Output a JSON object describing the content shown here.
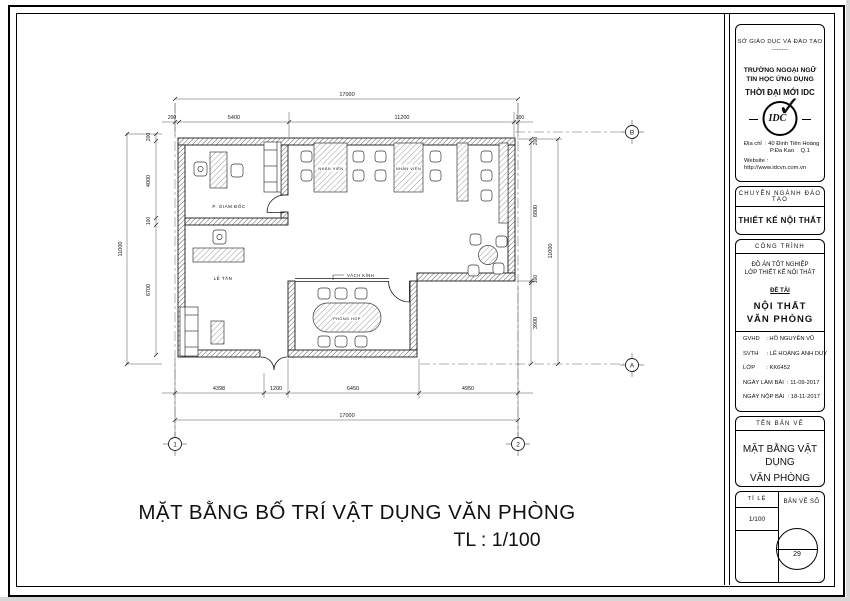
{
  "plan": {
    "labels": {
      "director": "P. GIÁM ĐỐC",
      "reception": "LỄ TÂN",
      "staff": "NHÂN VIÊN",
      "meeting": "PHÒNG HỌP",
      "glass": "VÁCH KÍNH"
    },
    "dims": {
      "top_total": "17000",
      "top": [
        "200",
        "5400",
        "11200",
        "200"
      ],
      "left_total": "11000",
      "left": [
        "200",
        "4000",
        "100",
        "6700"
      ],
      "right": [
        "200",
        "6800",
        "100",
        "3900"
      ],
      "right_total": "11000",
      "bottom": [
        "4398",
        "1200",
        "6450",
        "4950"
      ],
      "bottom_total": "17000"
    },
    "grid": {
      "c1": "1",
      "c2": "2",
      "rA": "A",
      "rB": "B"
    },
    "caption": "MẶT BẰNG BỐ TRÍ VẬT DỤNG VĂN PHÒNG",
    "caption_scale": "TL : 1/100"
  },
  "title_block": {
    "department": "SỞ GIÁO DỤC VÀ ĐÀO TẠO",
    "dots": "----------",
    "school_line1": "TRƯỜNG NGOẠI NGỮ",
    "school_line2": "TIN HỌC ỨNG DỤNG",
    "school_brand": "THỜI ĐẠI MỚI IDC",
    "logo_text": "IDC",
    "address_line1": "Địa chỉ  : 40 Đinh Tiên Hoàng",
    "address_line2": "P.Đa Kao    Q.1",
    "website": "Website : http://www.idcvn.com.vn",
    "major_header": "CHUYÊN NGÀNH ĐÀO TẠO",
    "major": "THIẾT KẾ NỘI THẤT",
    "project_header": "CÔNG TRÌNH",
    "project_line1": "ĐỒ ÁN TỐT NGHIỆP",
    "project_line2": "LỚP THIẾT KẾ NỘI THẤT",
    "topic_label": "ĐỀ TÀI",
    "topic_line1": "NỘI THẤT",
    "topic_line2": "VĂN PHÒNG",
    "rows": [
      "GVHD    : HỒ NGUYÊN VŨ",
      "SVTH     : LÊ HOÀNG ANH DUY",
      "LỚP       : KK6452",
      "NGÀY LÀM BÀI  : 11-09-2017",
      "NGÀY NỘP BÀI  : 18-11-2017"
    ],
    "sheet_header": "TÊN BẢN VẼ",
    "sheet_line1": "MẶT BẰNG VẬT DỤNG",
    "sheet_line2": "VĂN PHÒNG",
    "scale_label": "TỈ LỆ",
    "scale_value": "1/100",
    "number_label": "BẢN VẼ SỐ",
    "sheet_number": "29"
  }
}
